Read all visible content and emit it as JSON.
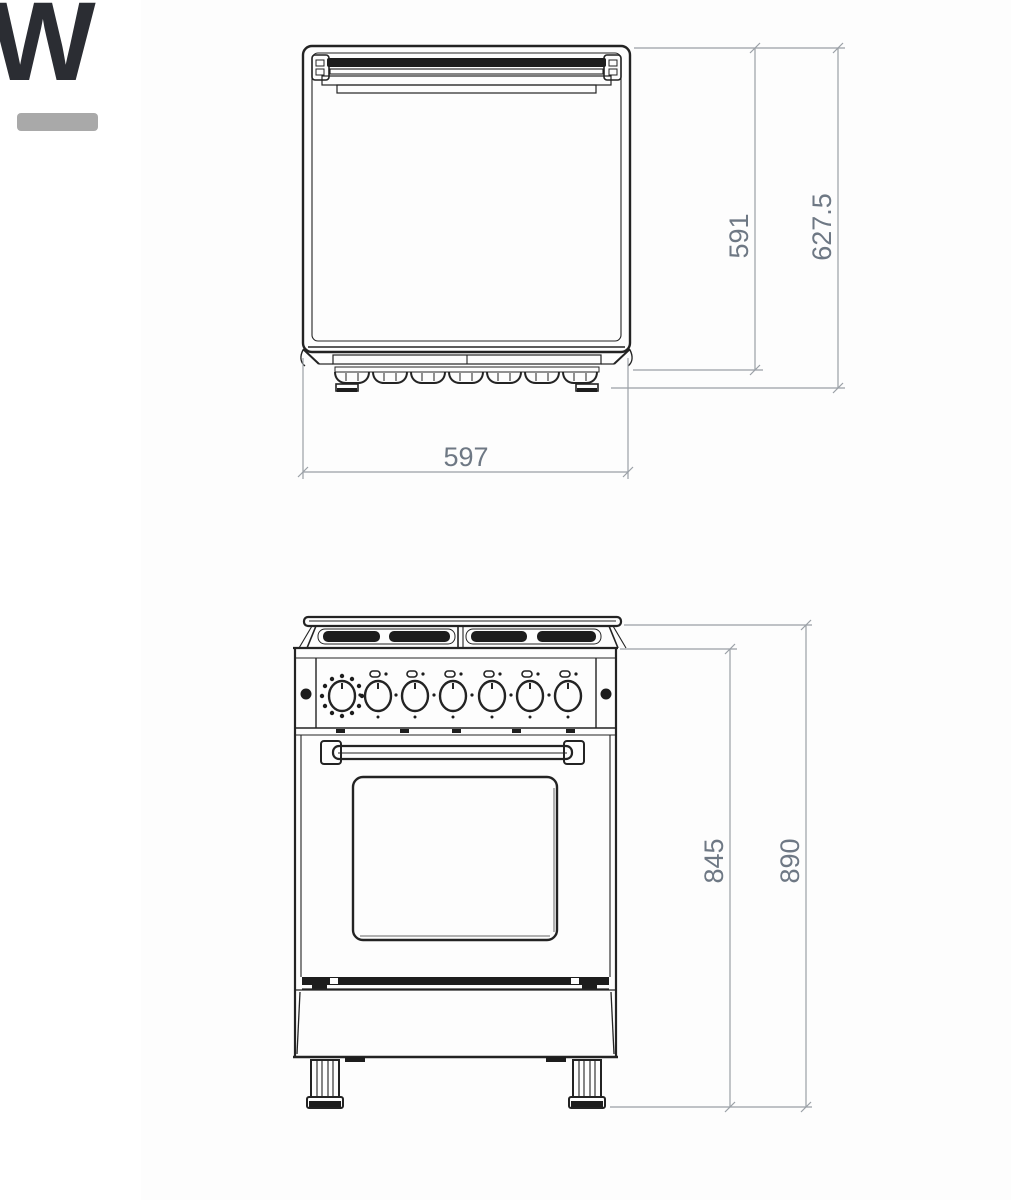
{
  "page": {
    "background_color": "#ffffff"
  },
  "logo": {
    "letter": "W",
    "letter_color": "#2b2d33",
    "underline_color": "#a9a9a9"
  },
  "diagram": {
    "line_color": "#232323",
    "dim_line_color": "#9aa0a6",
    "dim_text_color": "#6e7884",
    "top_view": {
      "width_label": "597",
      "depth_body_label": "591",
      "depth_overall_label": "627.5"
    },
    "front_view": {
      "height_body_label": "845",
      "height_overall_label": "890"
    }
  }
}
